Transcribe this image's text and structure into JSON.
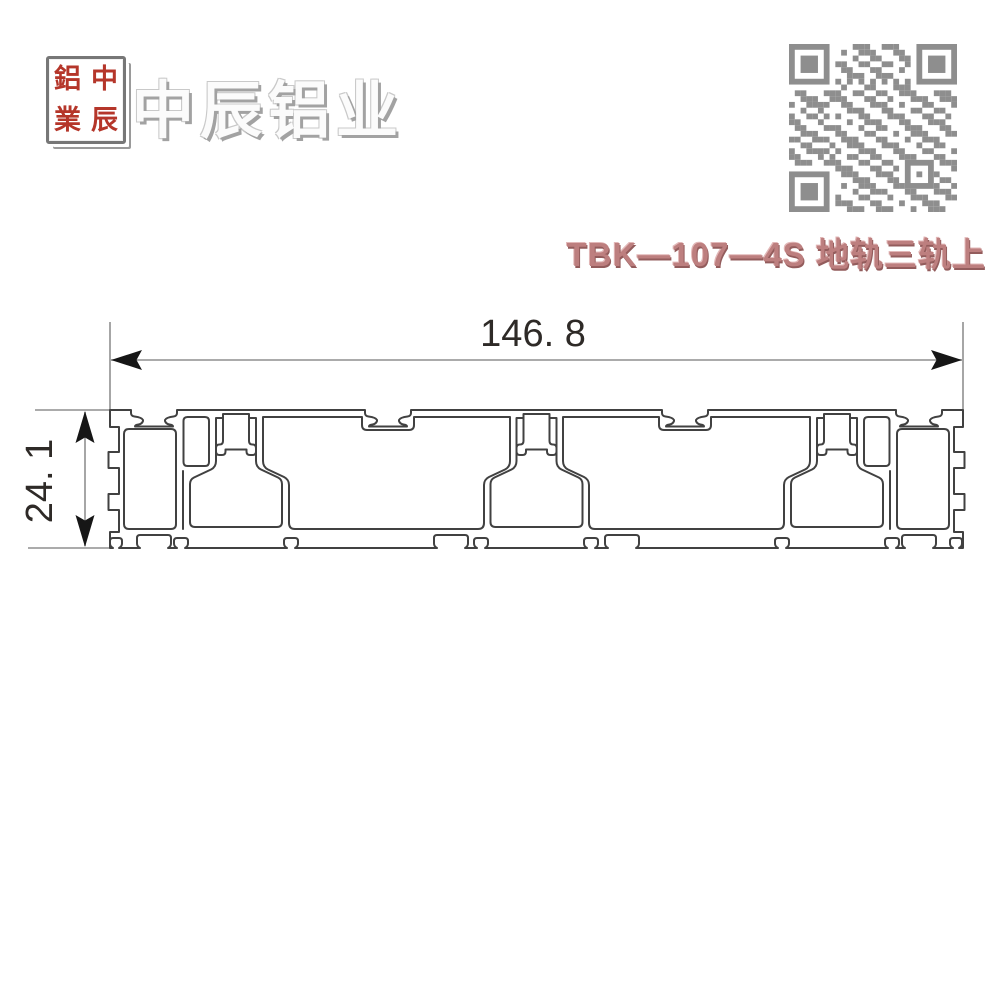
{
  "brand": {
    "company_name": "中辰铝业",
    "seal_characters": [
      "鋁",
      "中",
      "業",
      "辰"
    ],
    "seal_color": "#b5362a"
  },
  "product": {
    "model_label": "TBK—107—4S 地轨三轨上"
  },
  "drawing": {
    "width_dimension": "146. 8",
    "height_dimension": "24. 1",
    "line_color": "#414141",
    "dimension_line_color": "#8f8f8f"
  },
  "icons": {
    "qr_code": "qr-code"
  },
  "colors": {
    "seal_red": "#b5362a",
    "title_rose": "#bd7f7f",
    "qr_gray": "#8e8e8e",
    "logo_gray": "#fbfbfb"
  }
}
